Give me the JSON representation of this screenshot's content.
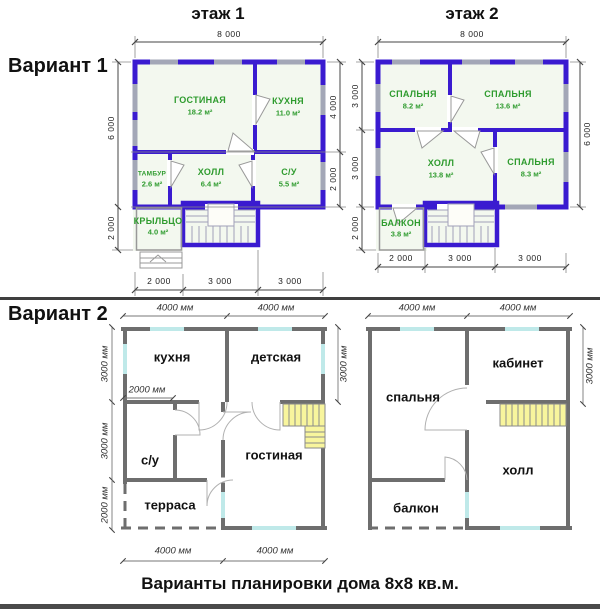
{
  "titles": {
    "floor1": "этаж 1",
    "floor2": "этаж 2",
    "variant1": "Вариант 1",
    "variant2": "Вариант 2",
    "caption": "Варианты планировки дома 8х8 кв.м."
  },
  "v1f1": {
    "rooms": {
      "living": {
        "name": "ГОСТИНАЯ",
        "area": "18.2 м²"
      },
      "kitchen": {
        "name": "КУХНЯ",
        "area": "11.0 м²"
      },
      "tambour": {
        "name": "ТАМБУР",
        "area": "2.6 м²"
      },
      "hall": {
        "name": "ХОЛЛ",
        "area": "6.4 м²"
      },
      "wc": {
        "name": "С/У",
        "area": "5.5 м²"
      },
      "porch": {
        "name": "КРЫЛЬЦО",
        "area": "4.0 м²"
      }
    },
    "dims": {
      "top": "8 000",
      "left_main": "6 000",
      "left_porch": "2 000",
      "right_upper": "4 000",
      "right_lower": "2 000",
      "bottom_1": "2 000",
      "bottom_2": "3 000",
      "bottom_3": "3 000"
    }
  },
  "v1f2": {
    "rooms": {
      "bedroom1": {
        "name": "СПАЛЬНЯ",
        "area": "8.2 м²"
      },
      "bedroom2": {
        "name": "СПАЛЬНЯ",
        "area": "13.6 м²"
      },
      "hall": {
        "name": "ХОЛЛ",
        "area": "13.8 м²"
      },
      "bedroom3": {
        "name": "СПАЛЬНЯ",
        "area": "8.3 м²"
      },
      "balcony": {
        "name": "БАЛКОН",
        "area": "3.8 м²"
      }
    },
    "dims": {
      "top": "8 000",
      "left_1": "3 000",
      "left_2": "3 000",
      "left_3": "2 000",
      "right": "6 000",
      "bottom_1": "2 000",
      "bottom_2": "3 000",
      "bottom_3": "3 000"
    }
  },
  "v2f1": {
    "rooms": {
      "kitchen": "кухня",
      "nursery": "детская",
      "wc": "с/у",
      "living": "гостиная",
      "terrace": "терраса"
    },
    "dims": {
      "top_1": "4000 мм",
      "top_2": "4000 мм",
      "left_1": "3000 мм",
      "left_2": "3000 мм",
      "left_3": "2000 мм",
      "right": "3000 мм",
      "inner": "2000 мм",
      "bottom_1": "4000 мм",
      "bottom_2": "4000 мм"
    }
  },
  "v2f2": {
    "rooms": {
      "bedroom": "спальня",
      "study": "кабинет",
      "hall": "холл",
      "balcony": "балкон"
    },
    "dims": {
      "top_1": "4000 мм",
      "top_2": "4000 мм",
      "right": "3000 мм"
    }
  },
  "colors": {
    "variant1_wall": "#3a1bd0",
    "variant1_window": "#a3a7b7",
    "variant2_wall": "#6e6e6e",
    "variant2_window": "#bfe9e9",
    "stairs_fill": "#f8f59d",
    "room_label": "#2e9b2e"
  }
}
